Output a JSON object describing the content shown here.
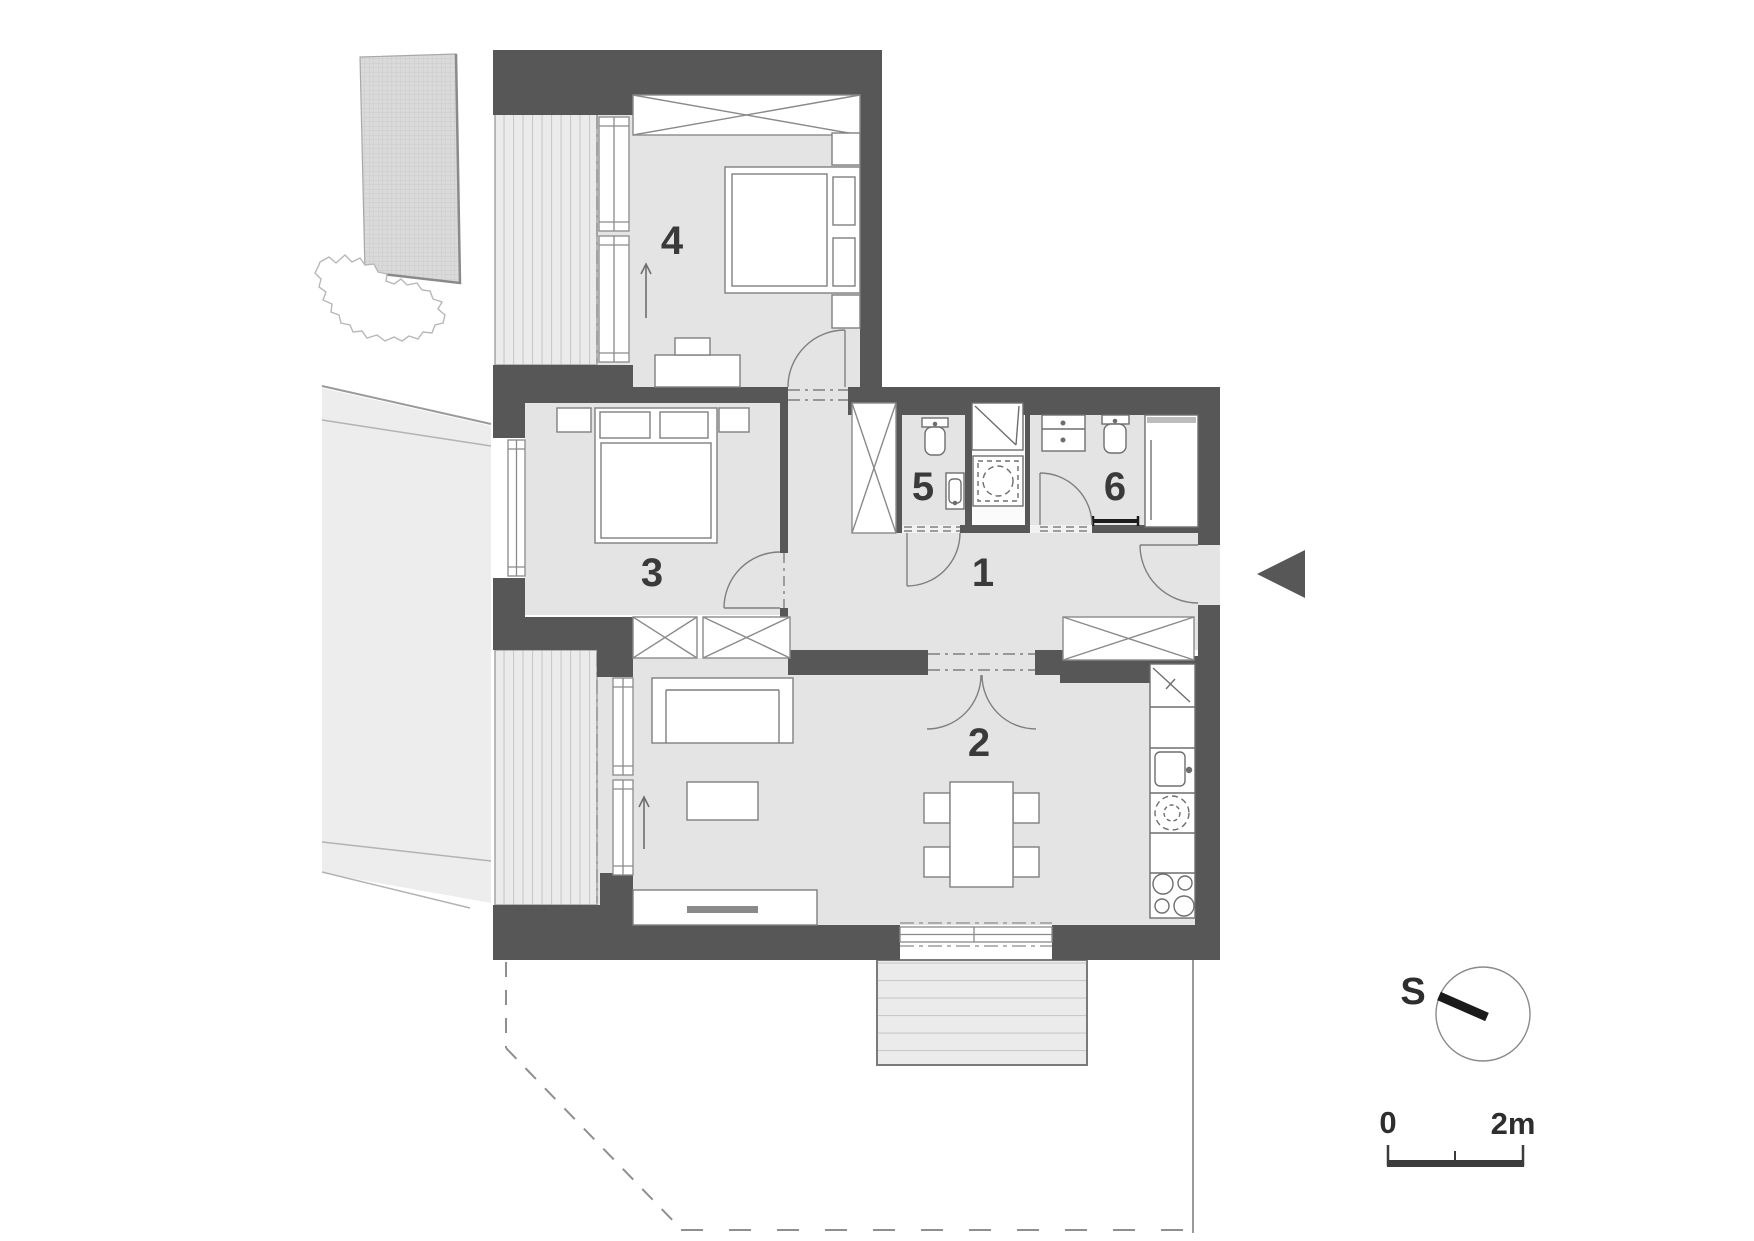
{
  "drawing": {
    "type": "apartment-floor-plan",
    "rooms": {
      "r1": {
        "label": "1"
      },
      "r2": {
        "label": "2"
      },
      "r3": {
        "label": "3"
      },
      "r4": {
        "label": "4"
      },
      "r5": {
        "label": "5"
      },
      "r6": {
        "label": "6"
      }
    },
    "compass": {
      "south_label": "S"
    },
    "scale_bar": {
      "zero_label": "0",
      "max_label": "2m"
    },
    "colors": {
      "wall": "#575757",
      "floor": "#e4e4e5",
      "outdoor_ground": "#ededee",
      "stripe": "#c9c9c9",
      "hatch_fill": "#dadada",
      "line": "#7f7f7f",
      "text": "#3a3a3a",
      "entry_marker": "#575757"
    }
  }
}
